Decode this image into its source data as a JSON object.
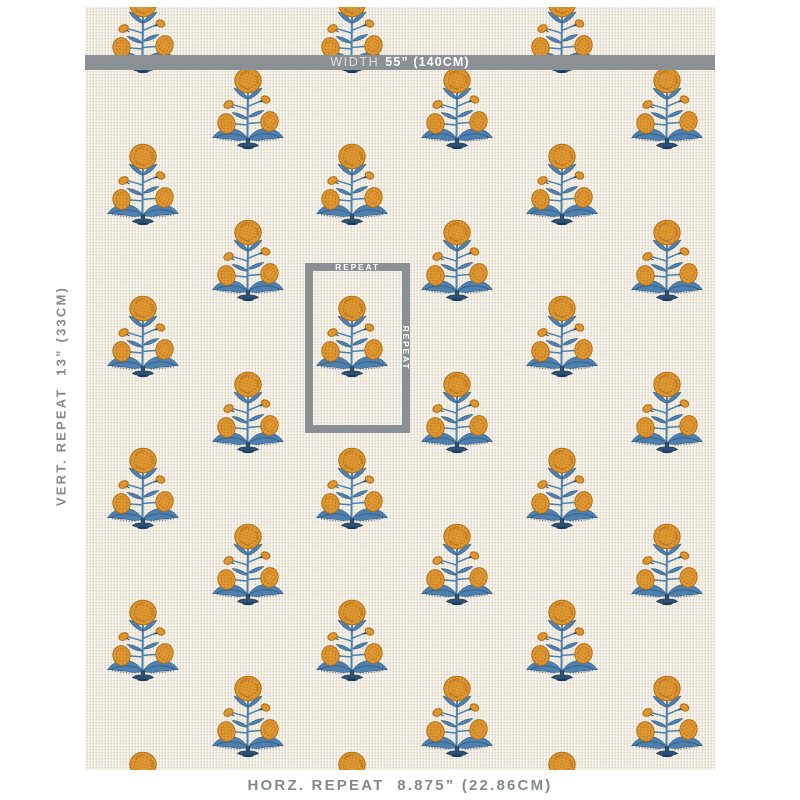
{
  "title": "Fabric swatch with repeat measurements",
  "annotations": {
    "width_bar": {
      "prefix": "WIDTH",
      "value": "55” (140CM)"
    },
    "vert_repeat_label": "VERT. REPEAT  13” (33CM)",
    "horz_repeat_label": "HORZ. REPEAT  8.875” (22.86CM)",
    "repeat_box": {
      "top_label": "REPEAT",
      "side_label": "REPEAT"
    }
  },
  "colors": {
    "white": "#ffffff",
    "fabricBg": "#f0ebdf",
    "gray": "#8b9094",
    "textGray": "#85898c",
    "orange": "#dd9530",
    "orangeDark": "#b06f16",
    "orangeLight": "#edbd6a",
    "blue": "#4d80ae",
    "blueDark": "#2b5176",
    "navy": "#1d3a57"
  },
  "pattern": {
    "motif_name": "marigold-block-print-flower",
    "columns_x": [
      58,
      163,
      267,
      372,
      477,
      582
    ],
    "column_first_motif_y": [
      -17,
      59,
      -17,
      59,
      -17,
      59
    ],
    "vertical_spacing": 152,
    "motif_size": {
      "width": 74,
      "height": 88
    }
  }
}
